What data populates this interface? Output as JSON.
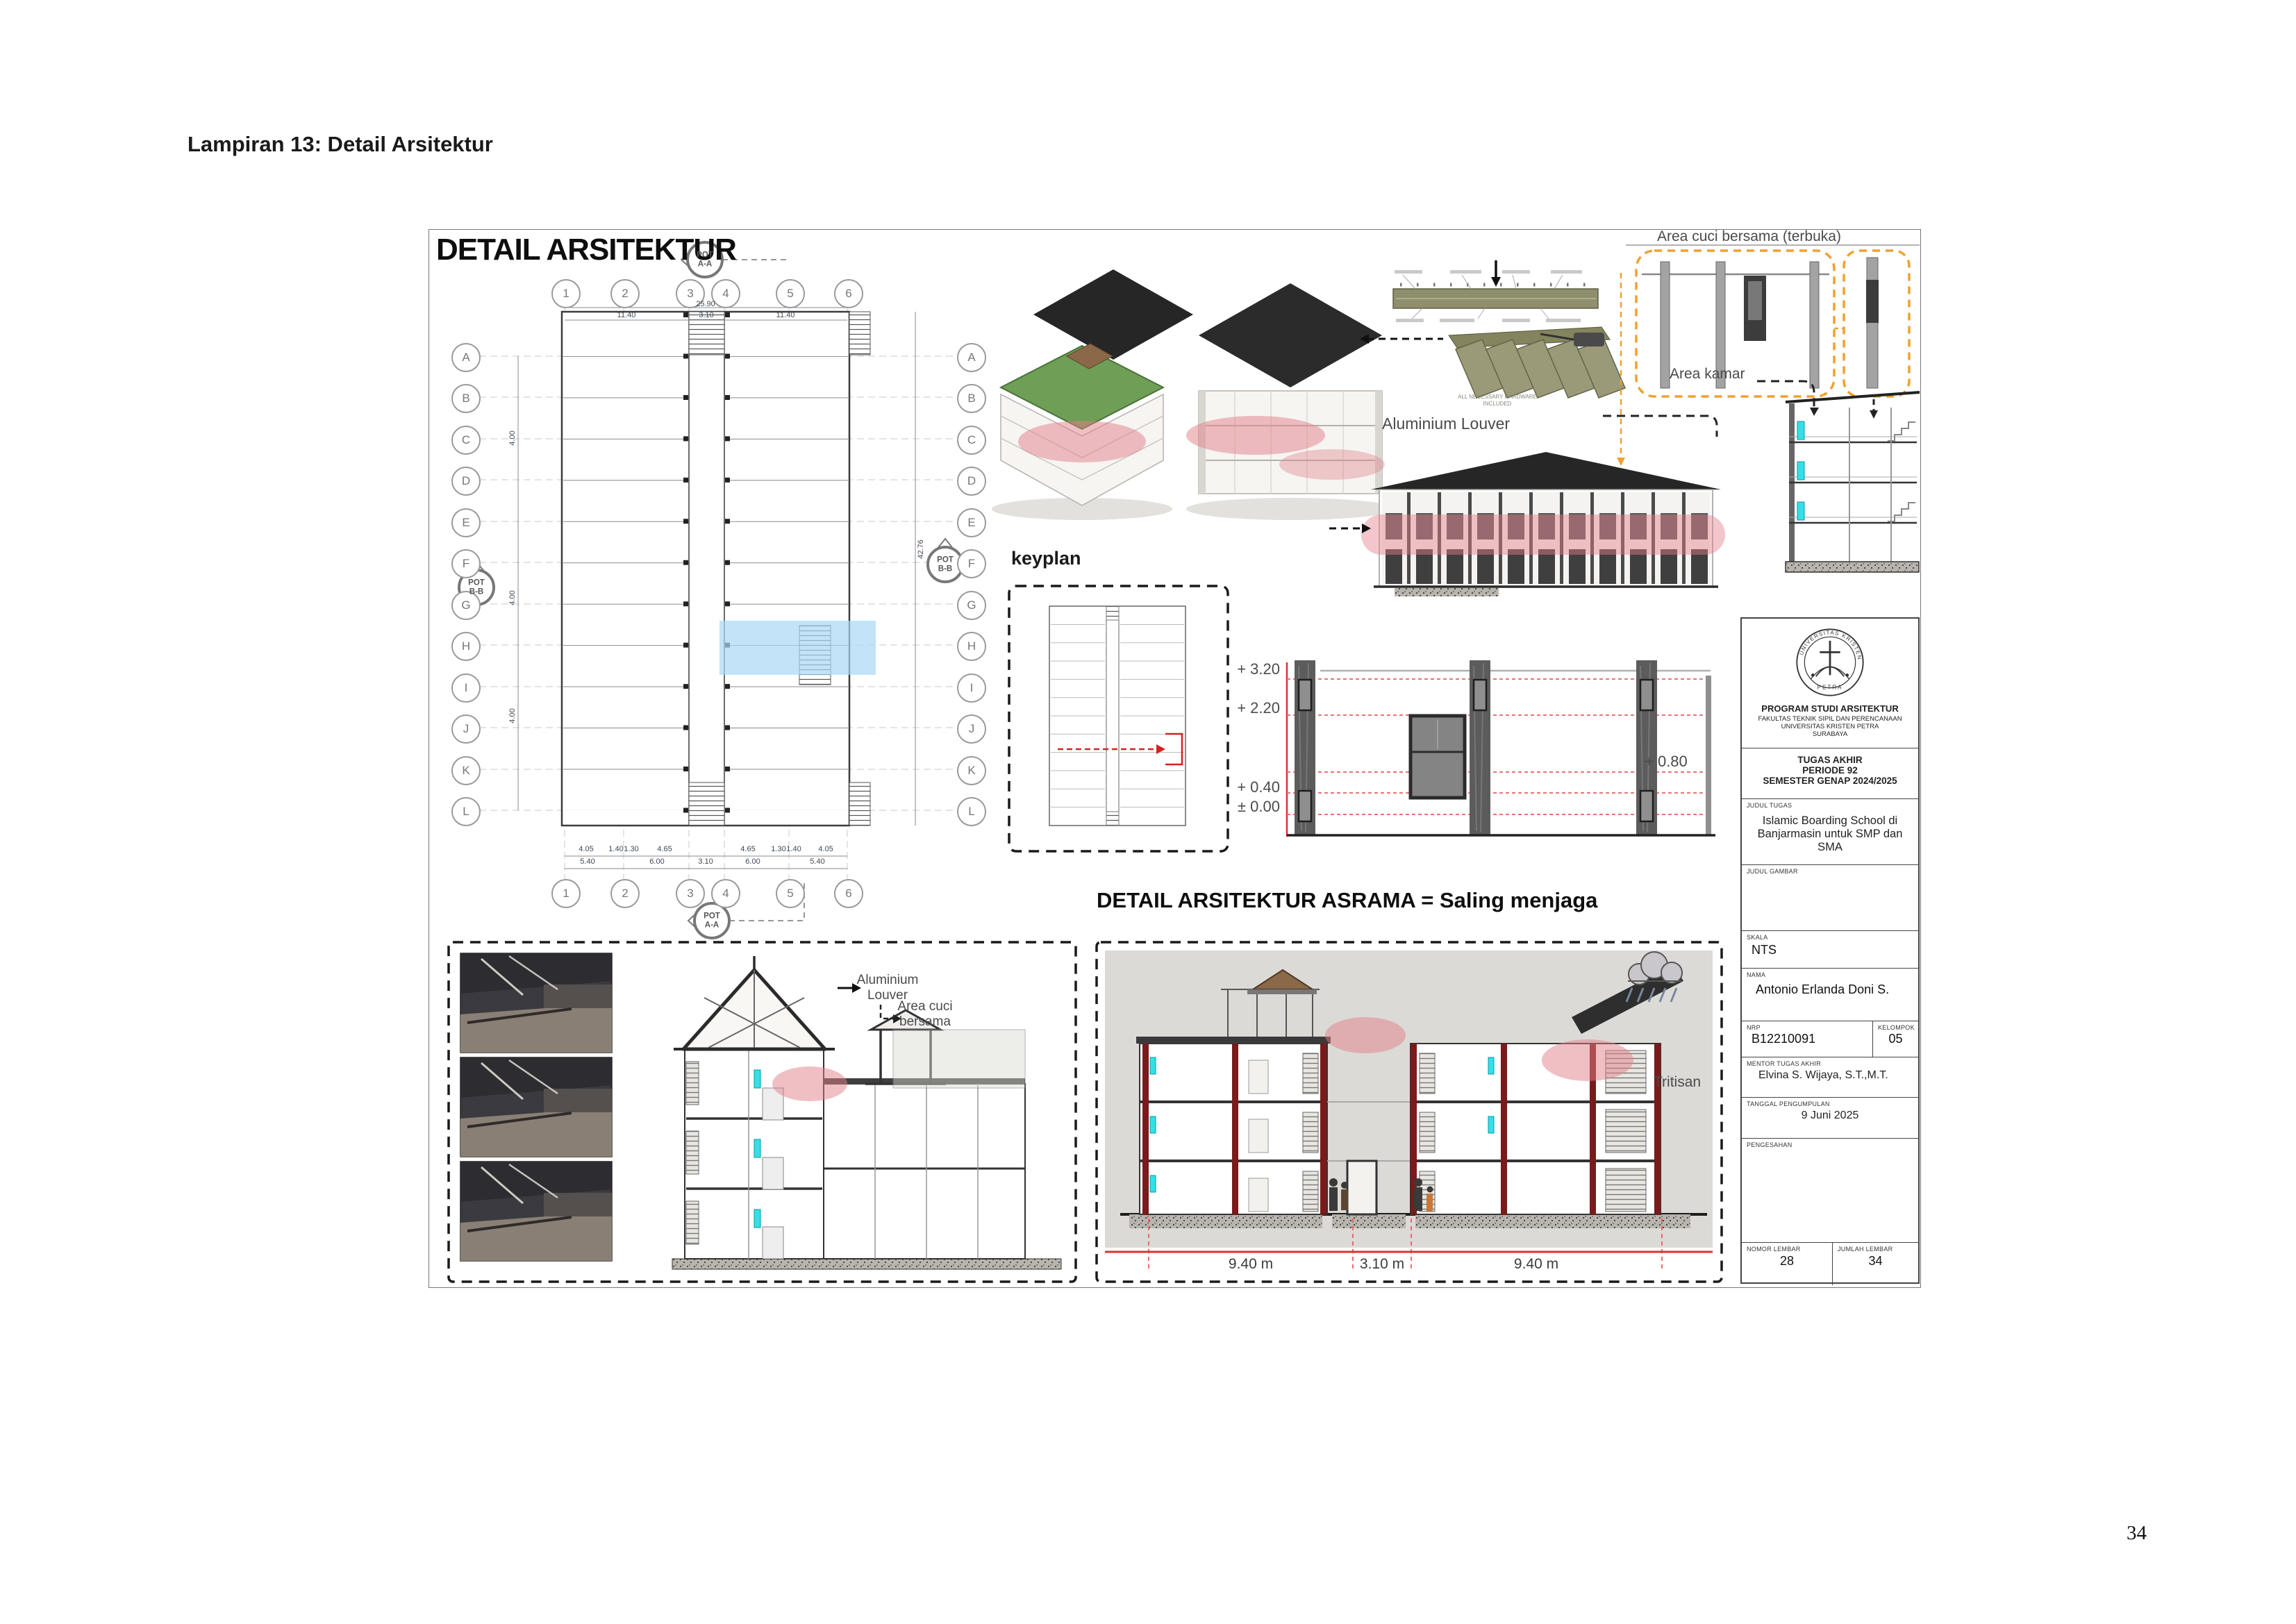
{
  "page": {
    "heading": "Lampiran 13: Detail Arsitektur",
    "page_number": "34"
  },
  "sheet": {
    "title": "DETAIL ARSITEKTUR"
  },
  "plan": {
    "grid_columns": [
      "1",
      "2",
      "3",
      "4",
      "5",
      "6"
    ],
    "grid_rows": [
      "A",
      "B",
      "C",
      "D",
      "E",
      "F",
      "G",
      "H",
      "I",
      "J",
      "K",
      "L"
    ],
    "pot_word": "POT",
    "pot_aa": "A-A",
    "pot_bb": "B-B",
    "dim_total_top": "25.90",
    "dims_top_segments": [
      "11.40",
      "3.10",
      "11.40"
    ],
    "dims_detail": [
      "4.05",
      "1.40",
      "1.30",
      "4.65",
      "4.65",
      "1.30",
      "1.40",
      "4.05"
    ],
    "dims_major": [
      "5.40",
      "6.00",
      "3.10",
      "6.00",
      "5.40"
    ],
    "left_dims": [
      "4.00",
      "4.00",
      "4.00"
    ],
    "dim_total_right": "42.76"
  },
  "annotations": {
    "keyplan": "keyplan",
    "aluminium_louver_top": "Aluminium Louver",
    "louver_caption": "ALL NECESSARY HARDWARE INCLUDED",
    "area_cuci_terbuka": "Area cuci bersama (terbuka)",
    "area_kamar": "Area kamar",
    "aluminium_louver_bottom": "Aluminium Louver",
    "area_cuci_bottom": "Area cuci bersama",
    "tritisan": "Tritisan"
  },
  "levels": {
    "left": [
      "+ 3.20",
      "+ 2.20",
      "+ 0.40",
      "± 0.00"
    ],
    "right": "+ 0.80"
  },
  "asrama": {
    "title": "DETAIL ARSITEKTUR ASRAMA = Saling menjaga",
    "dims": [
      "9.40 m",
      "3.10 m",
      "9.40 m"
    ]
  },
  "titleblock": {
    "logo_top": "UNIVERSITAS KRISTEN",
    "logo_bottom": "PETRA",
    "program": "PROGRAM STUDI ARSITEKTUR",
    "fakultas": "FAKULTAS TEKNIK SIPIL DAN PERENCANAAN",
    "universitas": "UNIVERSITAS KRISTEN PETRA",
    "kota": "SURABAYA",
    "tugas_l1": "TUGAS AKHIR",
    "tugas_l2": "PERIODE 92",
    "tugas_l3": "SEMESTER GENAP 2024/2025",
    "judul_tugas_label": "JUDUL TUGAS",
    "judul_tugas": "Islamic Boarding School di Banjarmasin untuk SMP dan SMA",
    "judul_gambar_label": "JUDUL GAMBAR",
    "skala_label": "SKALA",
    "skala": "NTS",
    "nama_label": "NAMA",
    "nama": "Antonio Erlanda Doni S.",
    "nrp_label": "NRP",
    "nrp": "B12210091",
    "kelompok_label": "KELOMPOK",
    "kelompok": "05",
    "mentor_label": "MENTOR TUGAS AKHIR",
    "mentor": "Elvina S. Wijaya, S.T.,M.T.",
    "tanggal_label": "TANGGAL PENGUMPULAN",
    "tanggal": "9 Juni 2025",
    "pengesahan_label": "PENGESAHAN",
    "nomor_label": "NOMOR LEMBAR",
    "nomor": "28",
    "jumlah_label": "JUMLAH LEMBAR",
    "jumlah": "34"
  },
  "colors": {
    "highlight_pink": "#e2808a",
    "highlight_blue": "#a9d7f5",
    "dashed_orange": "#f0a030",
    "level_red": "#e03131",
    "structure_darkred": "#7a1a1a",
    "accent_cyan": "#35dfe8",
    "roof_dark": "#262626",
    "louver_olive": "#9a9a78"
  }
}
